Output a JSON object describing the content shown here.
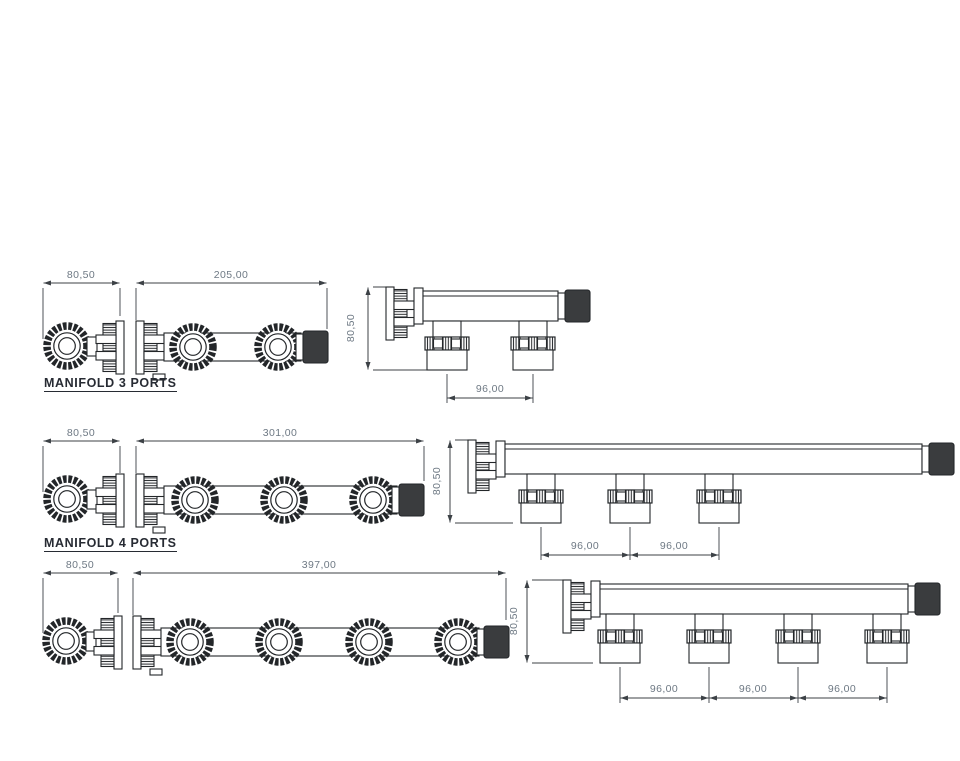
{
  "document": {
    "type": "technical-drawing",
    "background": "#ffffff"
  },
  "colors": {
    "line": "#232629",
    "dimension_text": "#6e7984",
    "label_text": "#272b33",
    "dark_fitting": "#3a3c3e"
  },
  "manifolds": [
    {
      "label": "MANIFOLD 3 PORTS",
      "dimensions": {
        "end_width": "80,50",
        "length": "205,00",
        "height": "80,50",
        "port_spacing": [
          "96,00"
        ]
      }
    },
    {
      "label": "MANIFOLD 4 PORTS",
      "dimensions": {
        "end_width": "80,50",
        "length": "301,00",
        "height": "80,50",
        "port_spacing": [
          "96,00",
          "96,00"
        ]
      }
    },
    {
      "dimensions": {
        "end_width": "80,50",
        "length": "397,00",
        "height": "80,50",
        "port_spacing": [
          "96,00",
          "96,00",
          "96,00"
        ]
      }
    }
  ]
}
